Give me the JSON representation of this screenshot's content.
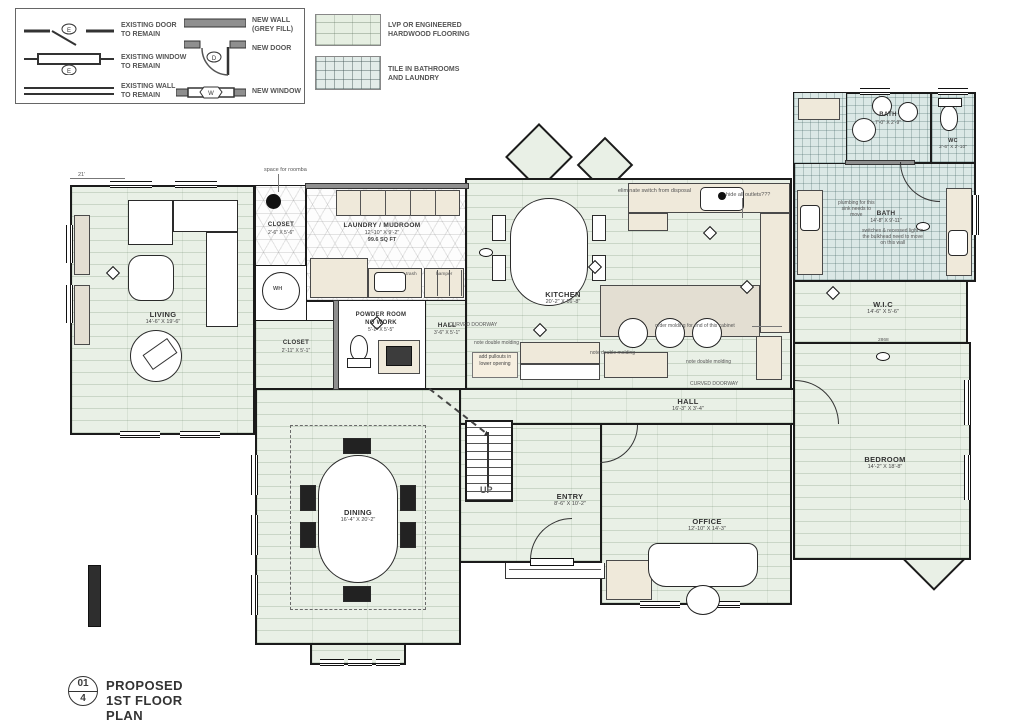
{
  "colors": {
    "wood_floor": "#e9f0e6",
    "tile_floor": "#dbe8e6",
    "wall": "#1b1b1b",
    "new_wall_grey": "#8f8f8f",
    "cabinet": "#efe9da"
  },
  "legend": {
    "existing_door": "EXISTING DOOR\nTO REMAIN",
    "existing_window": "EXISTING WINDOW\nTO REMAIN",
    "existing_wall": "EXISTING WALL\nTO REMAIN",
    "new_wall": "NEW WALL\n(GREY FILL)",
    "new_door": "NEW DOOR",
    "new_window": "NEW WINDOW"
  },
  "flooring": {
    "lvp": "LVP OR ENGINEERED\nHARDWOOD FLOORING",
    "tile": "TILE IN BATHROOMS\nAND LAUNDRY"
  },
  "rooms": [
    {
      "name": "LIVING",
      "dims": "14'-6\" X 19'-6\""
    },
    {
      "name": "CLOSET",
      "dims": "2'-6\" X 5'-6\""
    },
    {
      "name": "LAUNDRY / MUDROOM",
      "dims": "12'-10\" X 9'-2\"",
      "area": "99.6 SQ FT"
    },
    {
      "name": "CLOSET",
      "dims": "2'-11\" X 5'-1\""
    },
    {
      "name": "POWDER ROOM",
      "note": "NO WORK",
      "dims": "5'-1\" X 5'-5\""
    },
    {
      "name": "HALL",
      "dims": "3'-6\" X 5'-1\""
    },
    {
      "name": "KITCHEN",
      "dims": "20'-2\" X 16'-8\""
    },
    {
      "name": "DINING",
      "dims": "16'-4\" X 20'-2\""
    },
    {
      "name": "ENTRY",
      "dims": "8'-6\" X 10'-2\""
    },
    {
      "name": "OFFICE",
      "dims": "12'-10\" X 14'-3\""
    },
    {
      "name": "HALL",
      "dims": "16'-3\" X 3'-4\""
    },
    {
      "name": "BEDROOM",
      "dims": "14'-2\" X 18'-8\""
    },
    {
      "name": "W.I.C",
      "dims": "14'-6\" X 5'-6\""
    },
    {
      "name": "BATH",
      "dims": "7'-0\" X 2'-9\""
    },
    {
      "name": "WC",
      "dims": "2'-6\" X 2'-10\""
    },
    {
      "name": "BATH",
      "dims": "14'-8\" X 9'-11\""
    }
  ],
  "annotations": [
    {
      "text": "space for roomba"
    },
    {
      "text": "eliminate switch from disposal"
    },
    {
      "text": "hide all outlets???"
    },
    {
      "text": "trash"
    },
    {
      "text": "hamper"
    },
    {
      "text": "CURVED DOORWAY"
    },
    {
      "text": "CURVED DOORWAY"
    },
    {
      "text": "note double molding"
    },
    {
      "text": "note double molding"
    },
    {
      "text": "note double molding"
    },
    {
      "text": "add pullouts in\nlower opening"
    },
    {
      "text": "order molding for end of this cabinet"
    },
    {
      "text": "plumbing for this\nsink needs to\nmove"
    },
    {
      "text": "switches & recessed light in\nthe bulkhead need to move\non this wall"
    },
    {
      "text": "UP"
    },
    {
      "text": "2868"
    },
    {
      "text": "21'"
    },
    {
      "text": "WH"
    }
  ],
  "titleblock": {
    "num": "01",
    "denom": "4",
    "title": "PROPOSED 1ST FLOOR PLAN",
    "scale": "SCALE 3/16\" = 1'-0\""
  }
}
